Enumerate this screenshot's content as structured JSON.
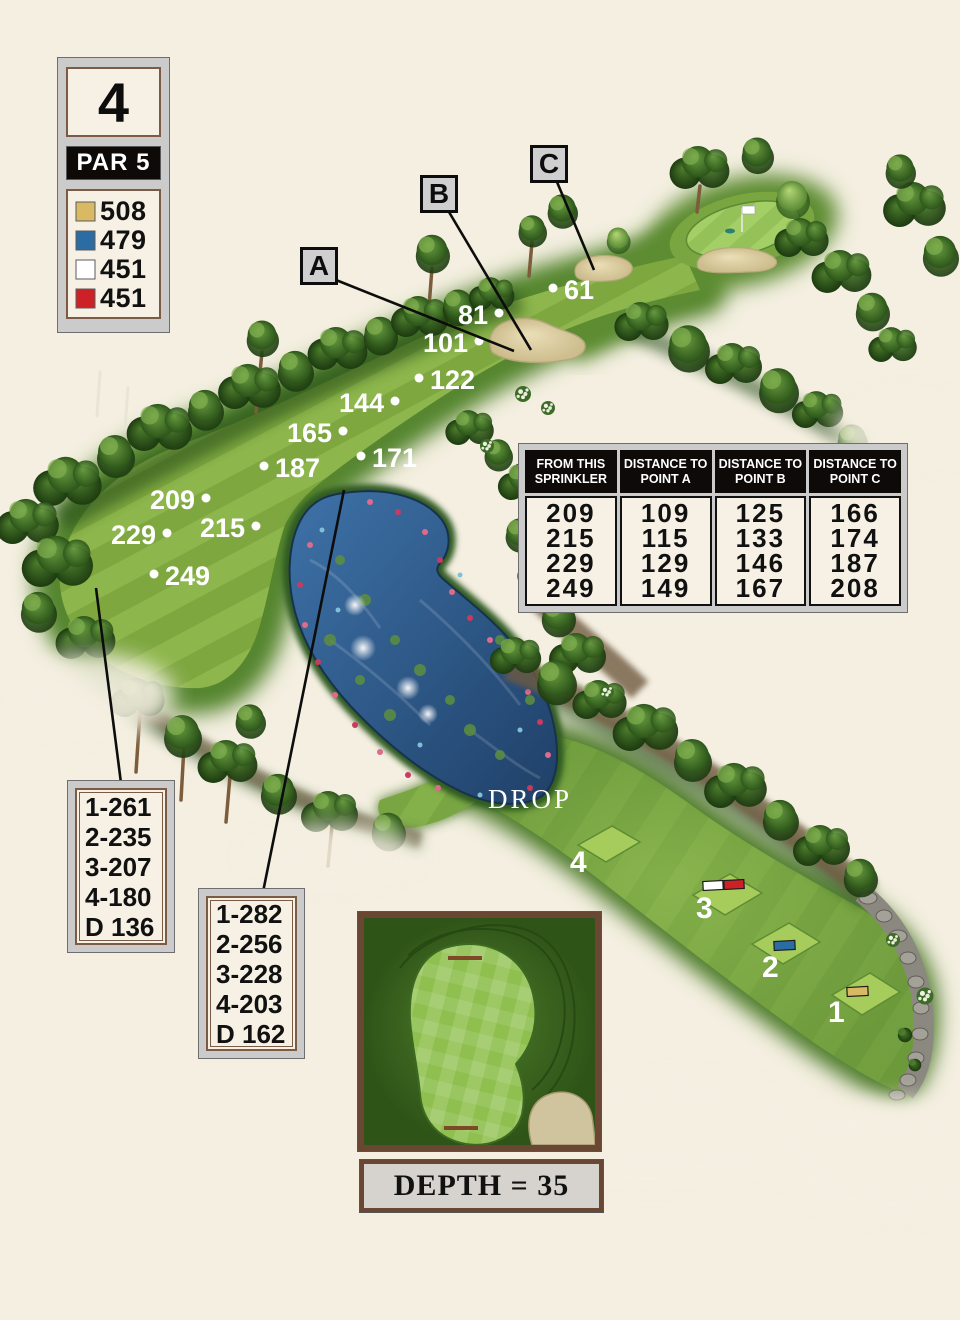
{
  "hole": {
    "number": "4",
    "par_label": "PAR 5",
    "tees": [
      {
        "name": "gold",
        "color": "#d9b964",
        "yardage": "508"
      },
      {
        "name": "blue",
        "color": "#2b6ca3",
        "yardage": "479"
      },
      {
        "name": "white",
        "color": "#ffffff",
        "yardage": "451"
      },
      {
        "name": "red",
        "color": "#cd2127",
        "yardage": "451"
      }
    ]
  },
  "hazard_labels": [
    {
      "letter": "A"
    },
    {
      "letter": "B"
    },
    {
      "letter": "C"
    }
  ],
  "sprinklers": [
    {
      "value": "61"
    },
    {
      "value": "81"
    },
    {
      "value": "101"
    },
    {
      "value": "122"
    },
    {
      "value": "144"
    },
    {
      "value": "165"
    },
    {
      "value": "187"
    },
    {
      "value": "171"
    },
    {
      "value": "209"
    },
    {
      "value": "215"
    },
    {
      "value": "229"
    },
    {
      "value": "249"
    }
  ],
  "sprinkler_table": {
    "columns": [
      {
        "header": "FROM THIS SPRINKLER",
        "values": [
          "209",
          "215",
          "229",
          "249"
        ]
      },
      {
        "header": "DISTANCE TO POINT A",
        "values": [
          "109",
          "115",
          "129",
          "149"
        ]
      },
      {
        "header": "DISTANCE TO POINT B",
        "values": [
          "125",
          "133",
          "146",
          "167"
        ]
      },
      {
        "header": "DISTANCE TO POINT C",
        "values": [
          "166",
          "174",
          "187",
          "208"
        ]
      }
    ]
  },
  "carry_boxes": [
    {
      "lines": [
        "1-261",
        "2-235",
        "3-207",
        "4-180",
        "D 136"
      ]
    },
    {
      "lines": [
        "1-282",
        "2-256",
        "3-228",
        "4-203",
        "D 162"
      ]
    }
  ],
  "tee_markers": [
    {
      "label": "4",
      "colors": []
    },
    {
      "label": "3",
      "colors": [
        "#ffffff",
        "#cd2127"
      ]
    },
    {
      "label": "2",
      "colors": [
        "#2b6ca3"
      ]
    },
    {
      "label": "1",
      "colors": [
        "#d9b964"
      ]
    }
  ],
  "drop_label": "DROP",
  "green_inset": {
    "depth_label": "DEPTH = 35"
  }
}
